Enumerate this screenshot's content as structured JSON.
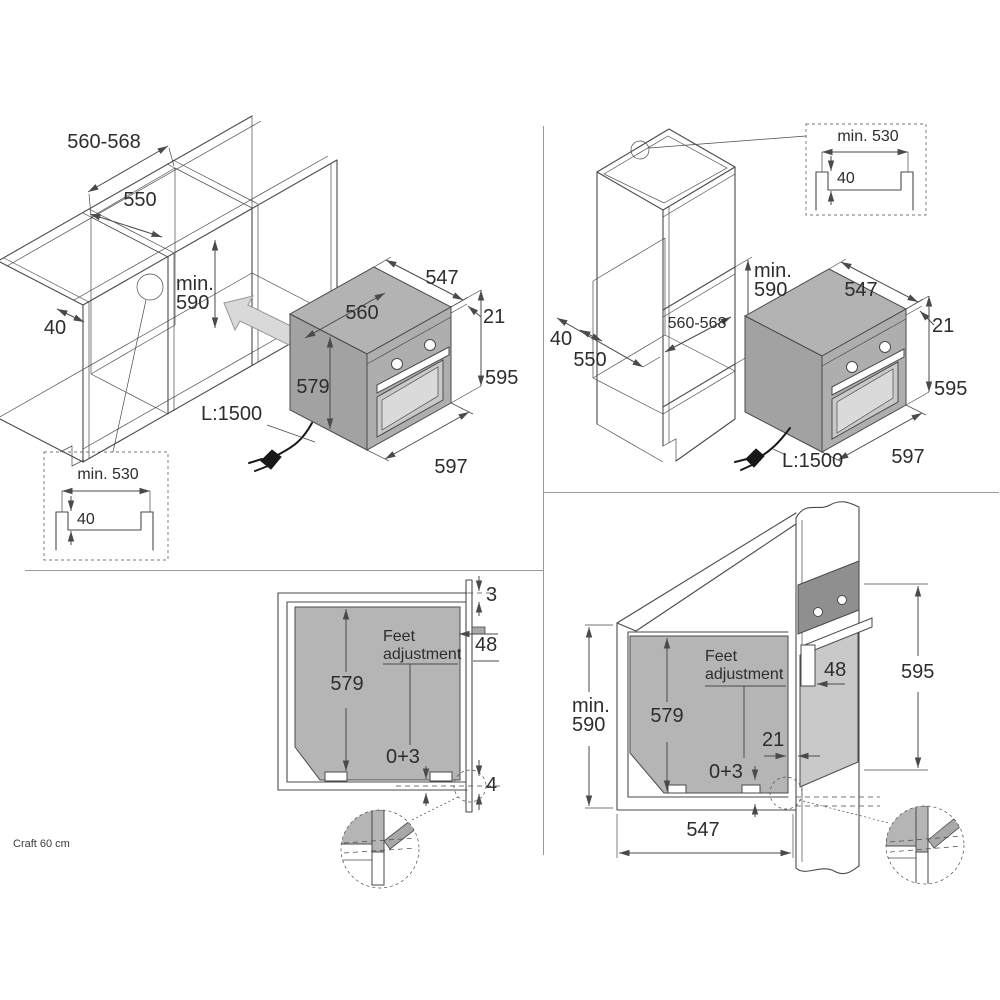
{
  "footer": {
    "label": "Craft 60 cm"
  },
  "colors": {
    "line": "#4a4a4a",
    "text": "#2d2d2d",
    "divider": "#9a9a9a",
    "oven_top": "#b3b3b3",
    "oven_side": "#a2a2a2",
    "oven_front": "#aeaeae",
    "door": "#c9c9c9",
    "door_inner": "#dadada",
    "section_gray": "#b5b5b5",
    "band": "#8f8f8f",
    "arrow_fill": "#d9d9d9",
    "bracket": "#a8a8a8"
  },
  "top_left": {
    "cabinet": {
      "niche_width": "560-568",
      "cabinet_depth": "550",
      "niche_height": "min.\n590",
      "rail_width": "40"
    },
    "oven": {
      "depth": "547",
      "inner_width": "560",
      "frame": "21",
      "body_height": "579",
      "front_height": "595",
      "width": "597",
      "cable": "L:1500"
    },
    "inset": {
      "min_width": "min. 530",
      "recess": "40"
    }
  },
  "top_right": {
    "inset": {
      "min_width": "min. 530",
      "recess": "40"
    },
    "cabinet": {
      "niche_height": "min.\n590",
      "niche_width": "560-568",
      "rail_width": "40",
      "cabinet_depth": "550"
    },
    "oven": {
      "depth": "547",
      "frame": "21",
      "front_height": "595",
      "width": "597",
      "cable": "L:1500"
    }
  },
  "bottom_left": {
    "top_gap": "3",
    "feet_label": "Feet\nadjustment",
    "bracket_depth": "48",
    "body_height": "579",
    "adjust_range": "0+3",
    "bottom_gap": "4"
  },
  "bottom_right": {
    "niche_height": "min.\n590",
    "body_height": "579",
    "feet_label": "Feet\nadjustment",
    "bracket_depth": "48",
    "front_height": "595",
    "door_gap": "21",
    "adjust_range": "0+3",
    "depth": "547"
  }
}
